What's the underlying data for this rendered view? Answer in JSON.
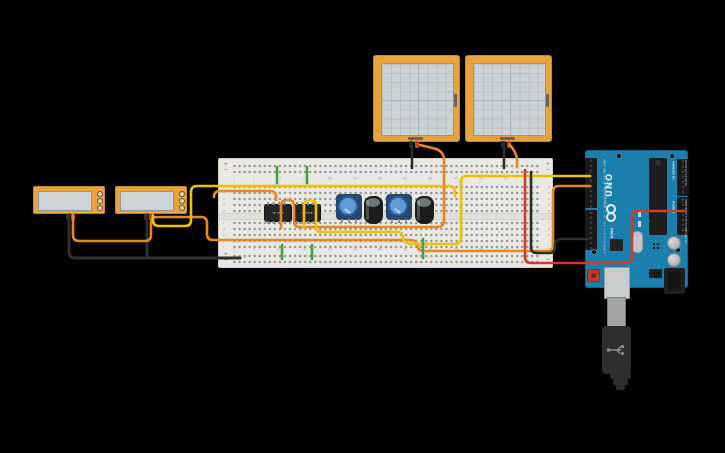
{
  "canvas": {
    "bg": "#000000"
  },
  "colors": {
    "frame_orange": "#E8A33D",
    "screen_gray": "#CBD3D6",
    "arduino_blue": "#1B7FAE",
    "breadboard": "#E9E8E3",
    "wire_yellow": "#EFC100",
    "wire_orange": "#E8871E",
    "wire_green": "#43A047",
    "wire_red": "#D33B2B",
    "wire_black": "#2E2E2E"
  },
  "breadboard": {
    "row_letters_top": "a\nb\nc\nd\ne",
    "row_letters_bottom": "f\ng\nh\ni\nj",
    "column_numbers": [
      {
        "t": "1",
        "x": 233
      },
      {
        "t": "5",
        "x": 253
      },
      {
        "t": "10",
        "x": 278
      },
      {
        "t": "15",
        "x": 303
      },
      {
        "t": "20",
        "x": 329
      },
      {
        "t": "25",
        "x": 354
      },
      {
        "t": "30",
        "x": 379
      },
      {
        "t": "35",
        "x": 404
      },
      {
        "t": "40",
        "x": 429
      },
      {
        "t": "45",
        "x": 455
      },
      {
        "t": "50",
        "x": 480
      },
      {
        "t": "55",
        "x": 505
      },
      {
        "t": "60",
        "x": 530
      }
    ],
    "rail_marks": [
      {
        "t": "+",
        "x": 223,
        "y": 161,
        "c": "#c0524a"
      },
      {
        "t": "−",
        "x": 223,
        "y": 167,
        "c": "#4a6fc0"
      },
      {
        "t": "+",
        "x": 545,
        "y": 161,
        "c": "#c0524a"
      },
      {
        "t": "−",
        "x": 545,
        "y": 167,
        "c": "#4a6fc0"
      },
      {
        "t": "+",
        "x": 223,
        "y": 251,
        "c": "#c0524a"
      },
      {
        "t": "−",
        "x": 223,
        "y": 257,
        "c": "#4a6fc0"
      },
      {
        "t": "+",
        "x": 545,
        "y": 251,
        "c": "#c0524a"
      },
      {
        "t": "−",
        "x": 545,
        "y": 257,
        "c": "#4a6fc0"
      }
    ]
  },
  "ics": [
    {
      "label": "op amp"
    },
    {
      "label": "op amp"
    }
  ],
  "arduino": {
    "uno_label": "UNO",
    "brand_label": "ARDUINO",
    "digital_label": "DIGITAL (PWM~)",
    "analog_label": "ANALOG IN",
    "power_label": "POWER",
    "digital_pins_top": "AREF GND 13 12 ~11 ~10 ~9 8",
    "digital_pins_bottom": "7 ~6 ~5 4 ~3 2 TX→1 RX←0",
    "analog_pins": "A0 A1 A2 A3 A4 A5",
    "power_pins": "IOREF RESET 3.3V 5V GND GND Vin"
  },
  "wires": [
    {
      "name": "wire-black-multimeter1-gnd",
      "color": "#2E2E2E",
      "w": 3,
      "d": "M69,215 L69,252 Q69,258 75,258 L240,258"
    },
    {
      "name": "wire-black-multimeter2-gnd",
      "color": "#2E2E2E",
      "w": 3,
      "d": "M147,215 L147,258"
    },
    {
      "name": "wire-orange-multimeter1-signal",
      "color": "#E8871E",
      "w": 2.6,
      "d": "M73,215 L73,235 Q73,241 79,241 L145,241 Q151,241 151,235 L151,223 Q151,217 157,217 L201,217 Q207,217 207,223 L207,234 Q207,240 213,240 L410,240 Q417,240 417,245 Q418,251 424,251 L547,251 Q553,251 553,245 L553,192 Q553,186 559,186 L590,186"
    },
    {
      "name": "wire-yellow-multimeter2-signal",
      "color": "#EFC100",
      "w": 2.6,
      "d": "M153,215 L153,220 Q153,226 159,226 L185,226 Q191,226 191,220 L191,192 Q191,186 197,186 L449,186 Q455,186 455,192 L455,196"
    },
    {
      "name": "wire-orange-row-stub",
      "color": "#E8871E",
      "w": 2.6,
      "d": "M214,197 Q214,191 220,191 L270,191 Q276,191 276,197 L276,200"
    },
    {
      "name": "wire-orange-ic1-to-scope1",
      "color": "#E8871E",
      "w": 2.6,
      "d": "M281,228 L281,206 Q281,200 287,200 L288,200 Q294,200 294,206 L294,221 Q294,227 300,227 L437,227 Q444,227 444,220 L444,160 Q444,152 436,149 Q425,146 420,145"
    },
    {
      "name": "wire-yellow-ic2-to-arduino",
      "color": "#EFC100",
      "w": 2.6,
      "d": "M304,228 L304,206 Q304,200 310,200 Q316,200 316,206 L316,226 Q316,232 322,232 L397,232 Q403,232 403,237 Q404,243 410,244 L455,244 Q461,244 461,238 L461,182 Q461,176 467,176 L590,176"
    },
    {
      "name": "wire-red-5v",
      "color": "#D33B2B",
      "w": 2.6,
      "d": "M684,211 L638,211 Q632,211 632,217 L632,257 Q632,263 626,263 L531,263 Q525,263 525,257 L525,170"
    },
    {
      "name": "wire-black-arduino-gnd",
      "color": "#2E2E2E",
      "w": 2.6,
      "d": "M531,172 L531,247 Q531,253 537,253 L549,253 Q555,253 555,247 L555,245 Q555,239 561,239 L590,239"
    },
    {
      "name": "wire-green-top-1",
      "color": "#43A047",
      "w": 2.6,
      "d": "M277,167 L277,183"
    },
    {
      "name": "wire-green-top-2",
      "color": "#43A047",
      "w": 2.6,
      "d": "M307,167 L307,183"
    },
    {
      "name": "wire-green-bottom-1",
      "color": "#43A047",
      "w": 2.6,
      "d": "M282,245 L282,259"
    },
    {
      "name": "wire-green-bottom-2",
      "color": "#43A047",
      "w": 2.6,
      "d": "M312,245 L312,259"
    },
    {
      "name": "wire-green-bottom-3",
      "color": "#43A047",
      "w": 2.6,
      "d": "M423,239 L423,258"
    },
    {
      "name": "wire-black-scope1",
      "color": "#2E2E2E",
      "w": 2.6,
      "d": "M412,146 L412,168"
    },
    {
      "name": "wire-black-scope2",
      "color": "#2E2E2E",
      "w": 2.6,
      "d": "M504,146 L504,168"
    },
    {
      "name": "wire-orange-scope2",
      "color": "#E8871E",
      "w": 2.6,
      "d": "M510,145 Q516,152 517,159 L517,167"
    }
  ]
}
